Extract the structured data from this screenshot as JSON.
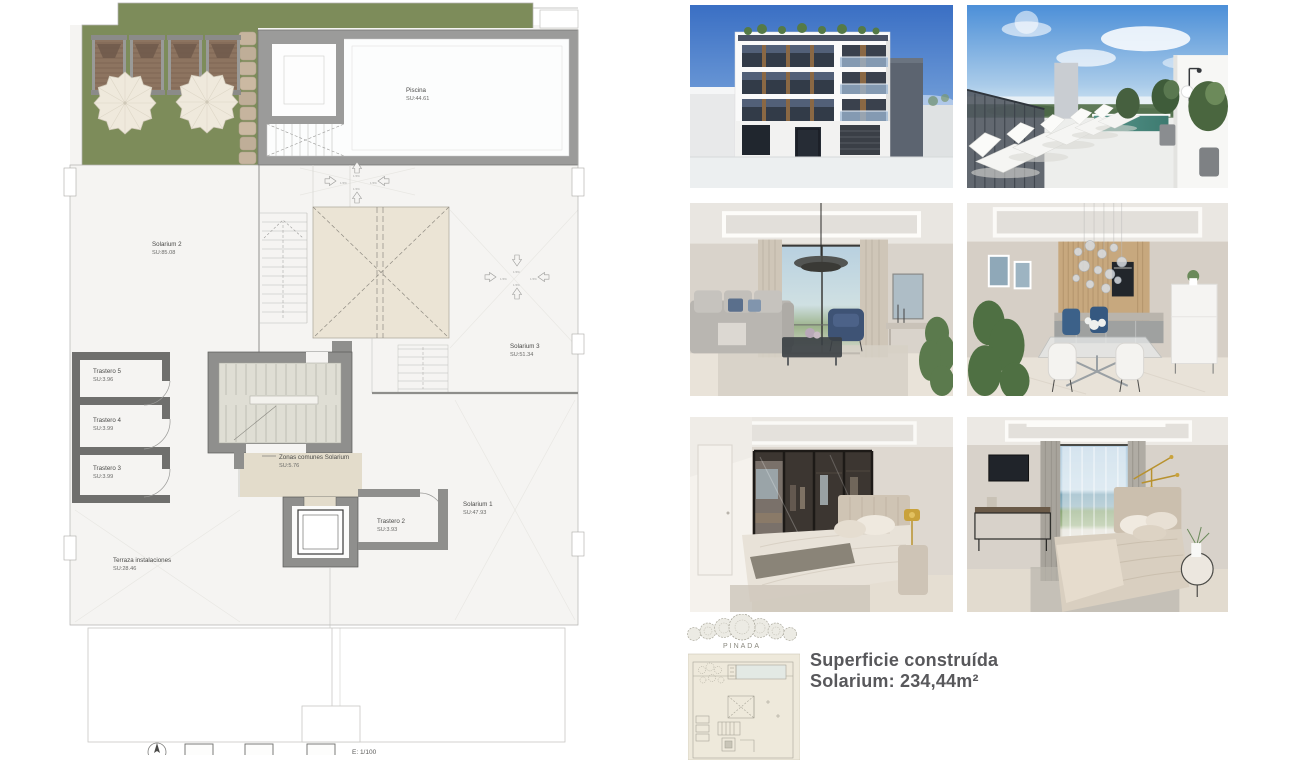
{
  "plan": {
    "rooms": {
      "piscina": {
        "name": "Piscina",
        "su": "SU:44.61"
      },
      "solarium2": {
        "name": "Solarium 2",
        "su": "SU:85.08"
      },
      "solarium3": {
        "name": "Solarium 3",
        "su": "SU:51.34"
      },
      "solarium1": {
        "name": "Solarium 1",
        "su": "SU:47.93"
      },
      "trastero5": {
        "name": "Trastero 5",
        "su": "SU:3.96"
      },
      "trastero4": {
        "name": "Trastero 4",
        "su": "SU:3.99"
      },
      "trastero3": {
        "name": "Trastero 3",
        "su": "SU:3.99"
      },
      "trastero2": {
        "name": "Trastero 2",
        "su": "SU:3.93"
      },
      "zonas_comunes": {
        "name": "Zonas comunes Solarium",
        "su": "SU:5.76"
      },
      "terraza": {
        "name": "Terraza instalaciones",
        "su": "SU:28.46"
      }
    },
    "slope_label": "1.5%",
    "scale_label": "E: 1/100"
  },
  "branding": {
    "grove_label": "PINADA"
  },
  "summary": {
    "line1": "Superficie construída",
    "line2": "Solarium: 234,44m²"
  },
  "colors": {
    "terrace_green": "#7d8c5a",
    "skylight_beige": "#ebe4d5",
    "wall_gray": "#8f8f8d",
    "dark_wall_gray": "#6f6f6d",
    "summary_text": "#58585b"
  }
}
